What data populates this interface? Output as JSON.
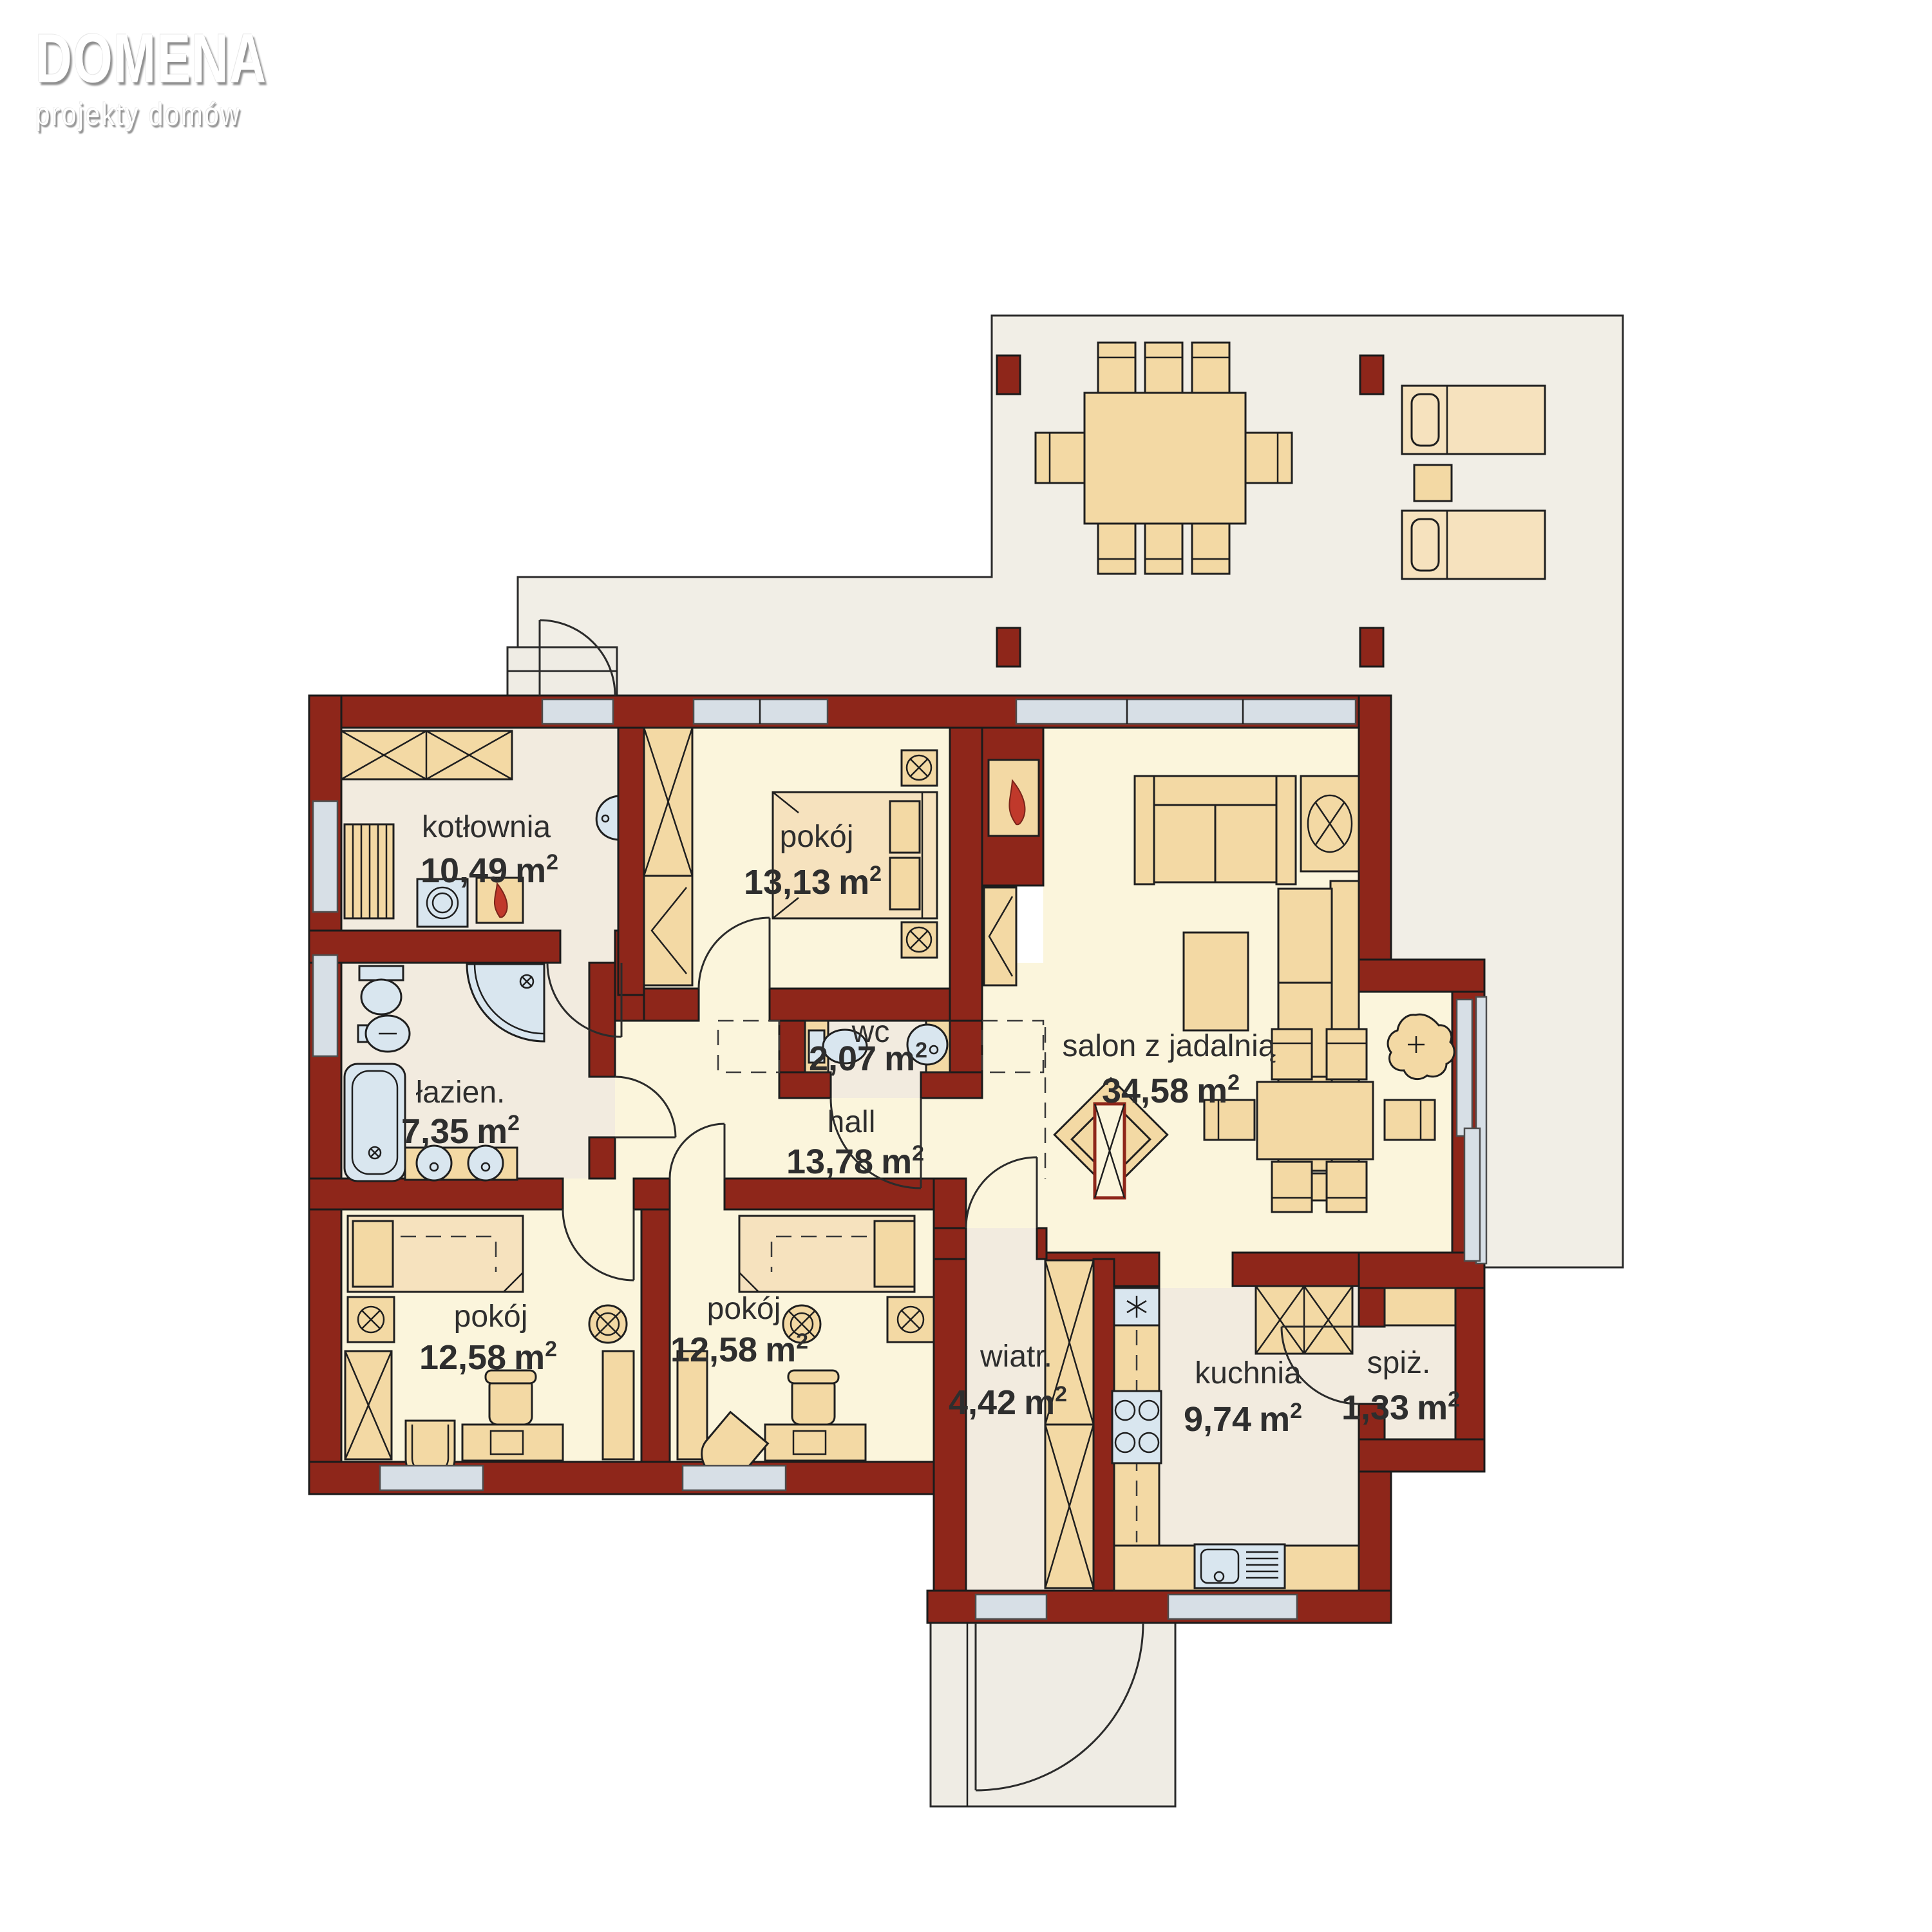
{
  "logo": {
    "title": "DOMENA",
    "subtitle": "projekty domów"
  },
  "units": {
    "m": "m",
    "sup": "2"
  },
  "rooms": [
    {
      "id": "kotlownia",
      "name": "kotłownia",
      "area": "10,49"
    },
    {
      "id": "pokoj-sypialnia",
      "name": "pokój",
      "area": "13,13"
    },
    {
      "id": "salon",
      "name": "salon z jadalnią",
      "area": "34,58"
    },
    {
      "id": "wc",
      "name": "wc",
      "area": "2,07"
    },
    {
      "id": "lazienka",
      "name": "łazien.",
      "area": "7,35"
    },
    {
      "id": "hall",
      "name": "hall",
      "area": "13,78"
    },
    {
      "id": "pokoj-1",
      "name": "pokój",
      "area": "12,58"
    },
    {
      "id": "pokoj-2",
      "name": "pokój",
      "area": "12,58"
    },
    {
      "id": "wiatrolap",
      "name": "wiatr.",
      "area": "4,42"
    },
    {
      "id": "kuchnia",
      "name": "kuchnia",
      "area": "9,74"
    },
    {
      "id": "spizarnia",
      "name": "spiż.",
      "area": "1,33"
    }
  ],
  "colors": {
    "wall": "#8E261A",
    "floor_cream": "#FBF5DC",
    "floor_beige": "#F2EBDF",
    "furniture": "#F3D9A4",
    "fixture_blue": "#D9E6EF",
    "glass": "#D7DFE6",
    "terrace": "#F1EEE6",
    "flame": "#C0392B",
    "text": "#2E2E2E",
    "logo": "#FFFFFF"
  }
}
